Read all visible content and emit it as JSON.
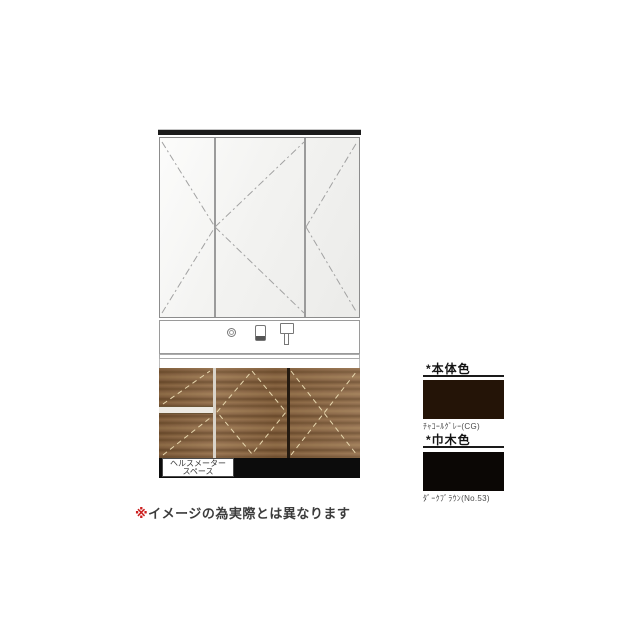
{
  "drawing": {
    "mirror_cabinet": {
      "door_count": 3,
      "description": "three-door mirror cabinet with door-swing dash marks"
    },
    "counter": {
      "icons": [
        "outlet-icon",
        "soap-dispenser-icon",
        "faucet-icon"
      ]
    },
    "base_cabinet": {
      "left_drawers": 2,
      "doors": 2
    },
    "health_meter_label": {
      "line1": "ヘルスメーター",
      "line2": "スペース"
    }
  },
  "color_options": {
    "body": {
      "heading": "*本体色",
      "label": "ﾁｬｺｰﾙｸﾞﾚｰ(CG)",
      "swatch_color": "#241407"
    },
    "baseboard": {
      "heading": "*巾木色",
      "label": "ﾀﾞｰｸﾌﾞﾗｳﾝ(No.53)",
      "swatch_color": "#0b0705"
    }
  },
  "disclaimer": {
    "marker": "※",
    "text": "イメージの為実際とは異なります"
  }
}
